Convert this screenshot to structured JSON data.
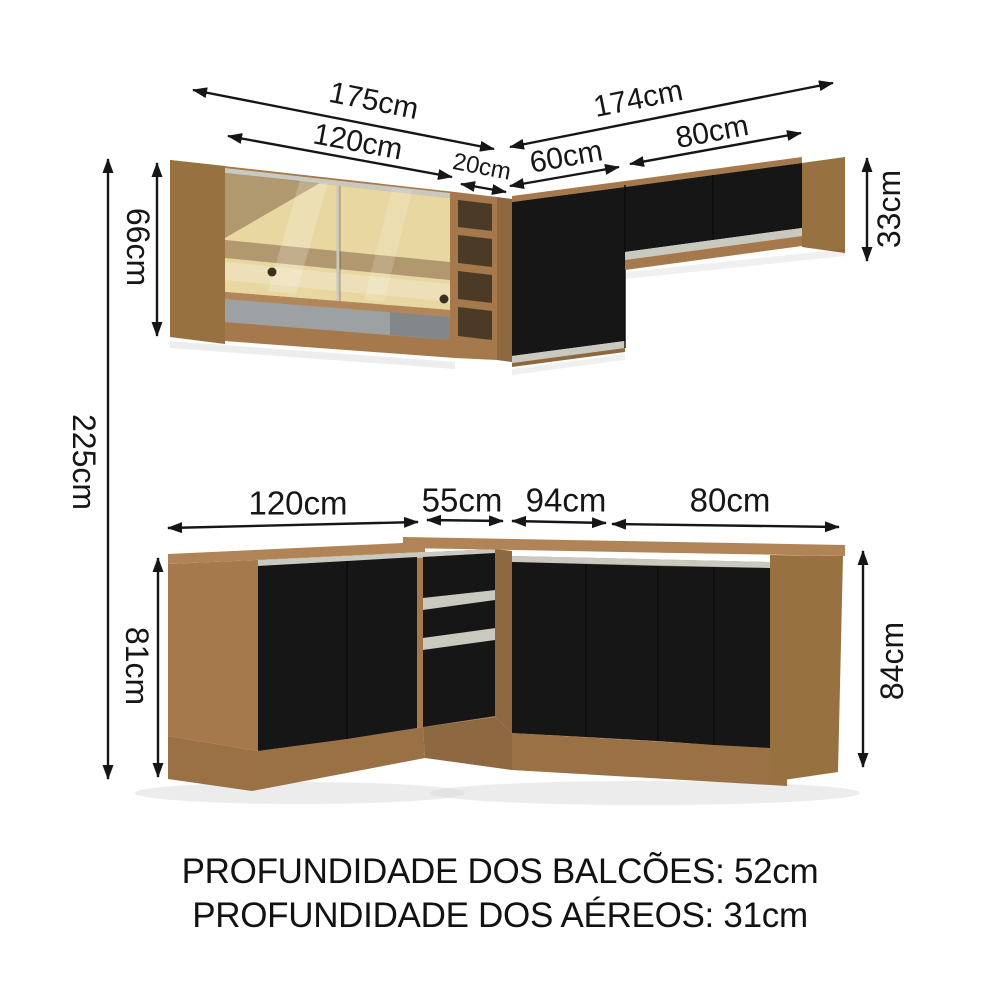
{
  "caption": {
    "line1": "PROFUNDIDADE DOS BALCÕES: 52cm",
    "line2": "PROFUNDIDADE DOS AÉREOS: 31cm"
  },
  "dims": {
    "total_height": "225cm",
    "upper": {
      "left_total": "175cm",
      "glass_cabinet": "120cm",
      "niche": "20cm",
      "height": "66cm",
      "right_total": "174cm",
      "corner_cabinet": "60cm",
      "right_cabinet": "80cm",
      "right_height": "33cm"
    },
    "base": {
      "left_cabinet": "120cm",
      "drawer_cabinet": "55cm",
      "corner_cabinet": "94cm",
      "right_cabinet": "80cm",
      "left_height": "81cm",
      "right_height": "84cm"
    }
  },
  "colors": {
    "wood": "#a5794c",
    "wood_side": "#97713f",
    "wood_dark": "#8d6840",
    "wood_light": "#b28658",
    "countertop": "#b08456",
    "plinth": "#9a7045",
    "plinth_dark": "#8d6840",
    "door_black": "#161616",
    "metal": "#c9c9bf",
    "glass_gold": "#e8d7a0",
    "niche_dark": "#4a3a26",
    "shelf_gray": "#9ea1a3",
    "arrow": "#161616"
  }
}
